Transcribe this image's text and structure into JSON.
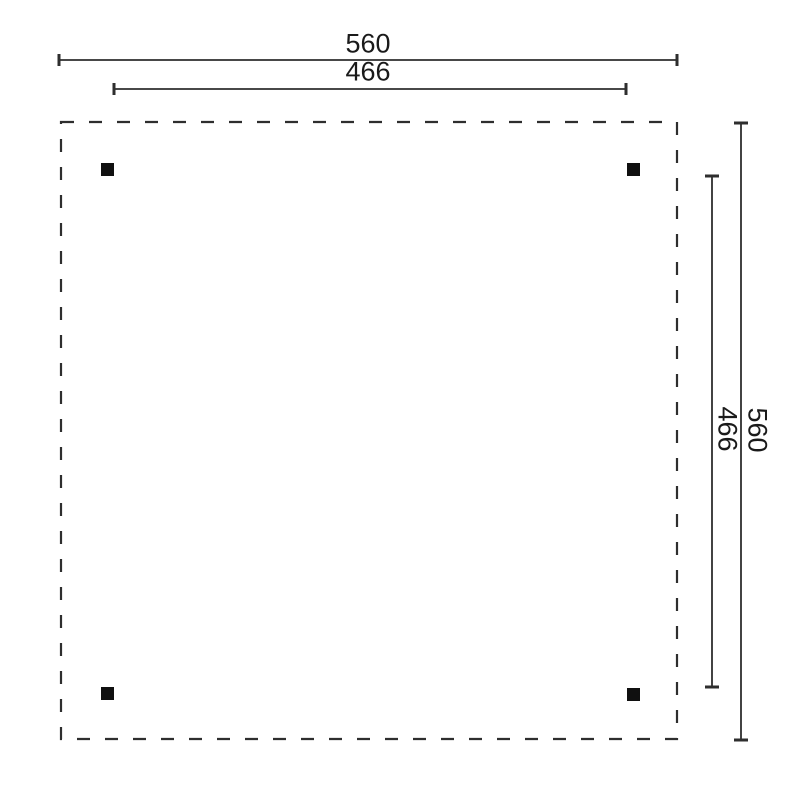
{
  "drawing": {
    "kind": "dimensioned floor plan",
    "posts_count": 4,
    "dimensions": [
      {
        "id": "top-outer",
        "label": "560",
        "orientation": "horizontal"
      },
      {
        "id": "top-inner",
        "label": "466",
        "orientation": "horizontal"
      },
      {
        "id": "right-outer",
        "label": "560",
        "orientation": "vertical"
      },
      {
        "id": "right-inner",
        "label": "466",
        "orientation": "vertical"
      }
    ],
    "colors": {
      "line": "#2e2e2e",
      "post": "#101010",
      "text": "#1a1a1a",
      "background": "#ffffff"
    }
  }
}
